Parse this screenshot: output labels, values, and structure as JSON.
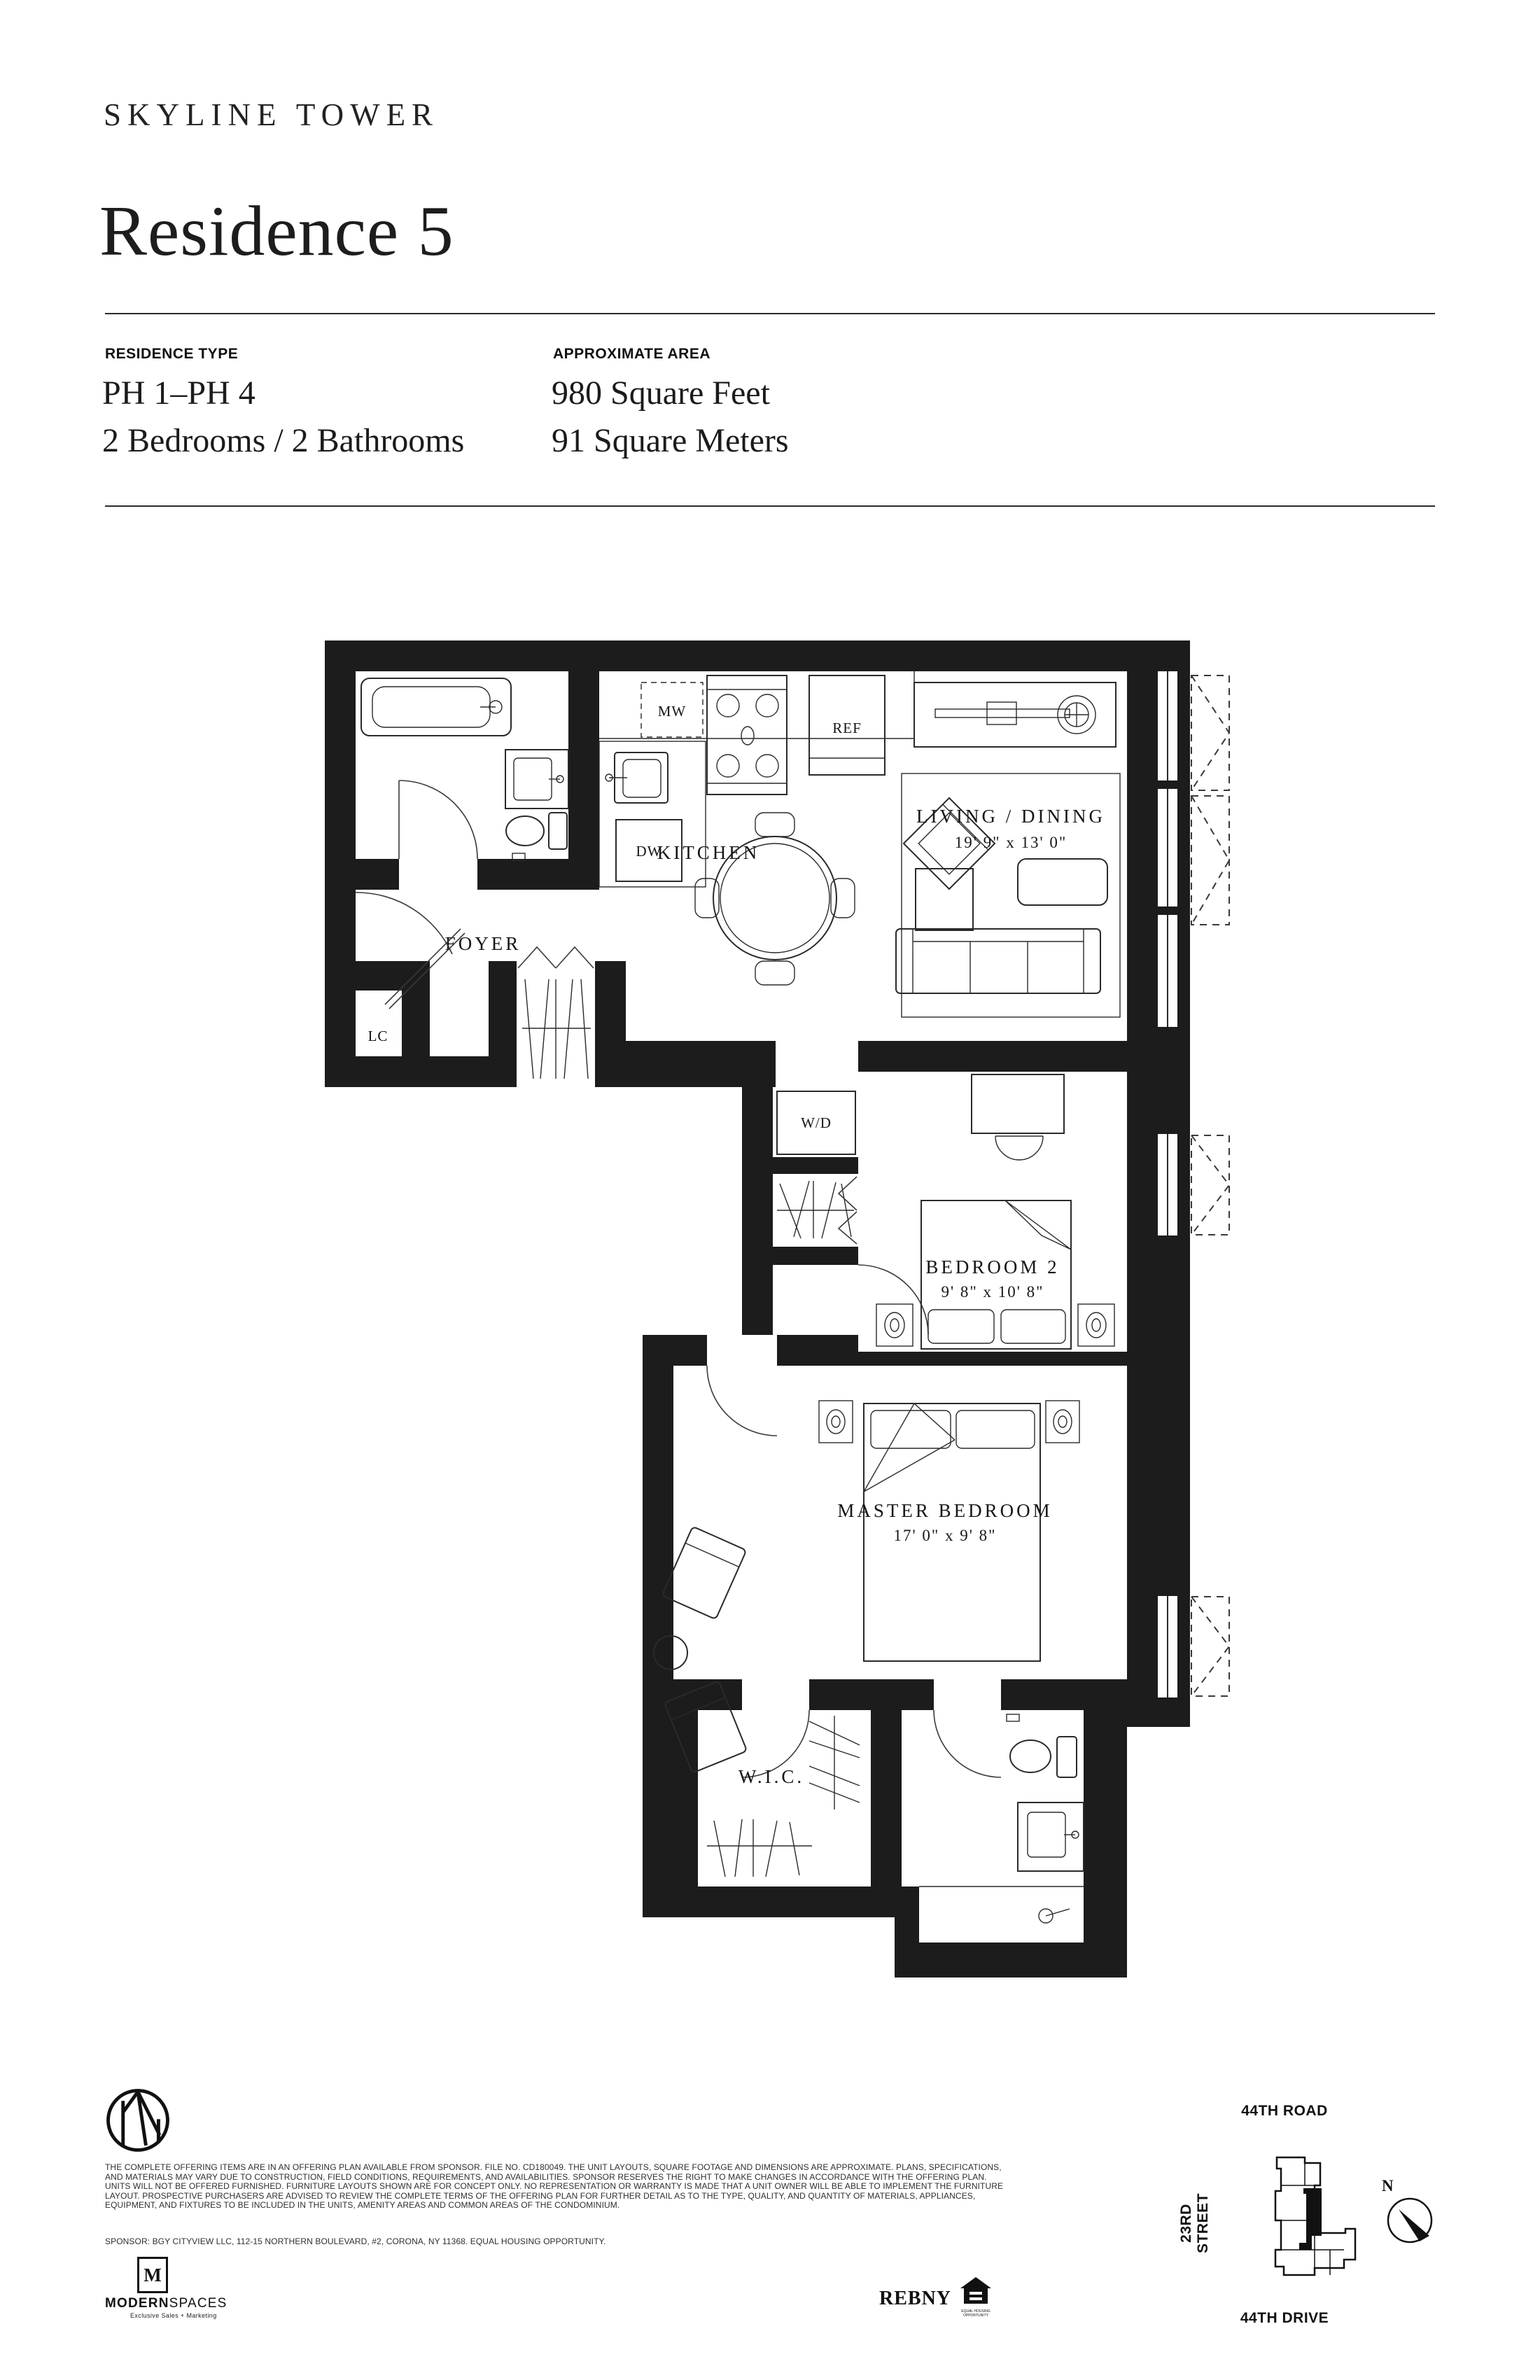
{
  "header": {
    "brand": "SKYLINE TOWER",
    "title": "Residence 5"
  },
  "specs": {
    "residence_type_label": "RESIDENCE TYPE",
    "residence_type_line1": "PH 1–PH 4",
    "residence_type_line2": "2 Bedrooms / 2 Bathrooms",
    "area_label": "APPROXIMATE AREA",
    "area_line1": "980 Square Feet",
    "area_line2": "91 Square Meters"
  },
  "floor_plan": {
    "rooms": {
      "kitchen": {
        "label": "KITCHEN"
      },
      "living": {
        "label": "LIVING / DINING",
        "dims": "19' 9\" x 13' 0\""
      },
      "foyer": {
        "label": "FOYER"
      },
      "bedroom2": {
        "label": "BEDROOM 2",
        "dims": "9' 8\" x 10' 8\""
      },
      "master": {
        "label": "MASTER BEDROOM",
        "dims": "17' 0\" x 9' 8\""
      },
      "wic": {
        "label": "W.I.C."
      }
    },
    "fixtures": {
      "mw": "MW",
      "ref": "REF",
      "dw": "DW",
      "wd": "W/D",
      "lc": "LC"
    }
  },
  "footer": {
    "disclaimer": "THE COMPLETE OFFERING ITEMS ARE IN AN OFFERING PLAN AVAILABLE FROM SPONSOR. FILE NO. CD180049. THE UNIT LAYOUTS, SQUARE FOOTAGE AND DIMENSIONS ARE APPROXIMATE. PLANS, SPECIFICATIONS, AND MATERIALS MAY VARY DUE TO CONSTRUCTION, FIELD CONDITIONS, REQUIREMENTS, AND AVAILABILITIES. SPONSOR RESERVES THE RIGHT TO MAKE CHANGES IN ACCORDANCE WITH THE OFFERING PLAN. UNITS WILL NOT BE OFFERED FURNISHED. FURNITURE LAYOUTS SHOWN ARE FOR CONCEPT ONLY. NO REPRESENTATION OR WARRANTY IS MADE THAT A UNIT OWNER WILL BE ABLE TO IMPLEMENT THE FURNITURE LAYOUT. PROSPECTIVE PURCHASERS ARE ADVISED TO REVIEW THE COMPLETE TERMS OF THE OFFERING PLAN FOR FURTHER DETAIL AS TO THE TYPE, QUALITY, AND QUANTITY OF MATERIALS, APPLIANCES, EQUIPMENT, AND FIXTURES TO BE INCLUDED IN THE UNITS, AMENITY AREAS AND COMMON AREAS OF THE CONDOMINIUM.",
    "sponsor": "SPONSOR: BGY CITYVIEW LLC, 112-15 NORTHERN BOULEVARD, #2, CORONA, NY 11368. EQUAL HOUSING OPPORTUNITY.",
    "modern_spaces": {
      "logo_letter": "M",
      "name_bold": "MODERN",
      "name_light": "SPACES",
      "tagline": "Exclusive Sales + Marketing"
    },
    "rebny": "REBNY",
    "equal_housing": "EQUAL HOUSING OPPORTUNITY"
  },
  "key_plan": {
    "road_top": "44TH ROAD",
    "street_left": "23RD STREET",
    "road_bottom": "44TH DRIVE",
    "compass": "N"
  }
}
